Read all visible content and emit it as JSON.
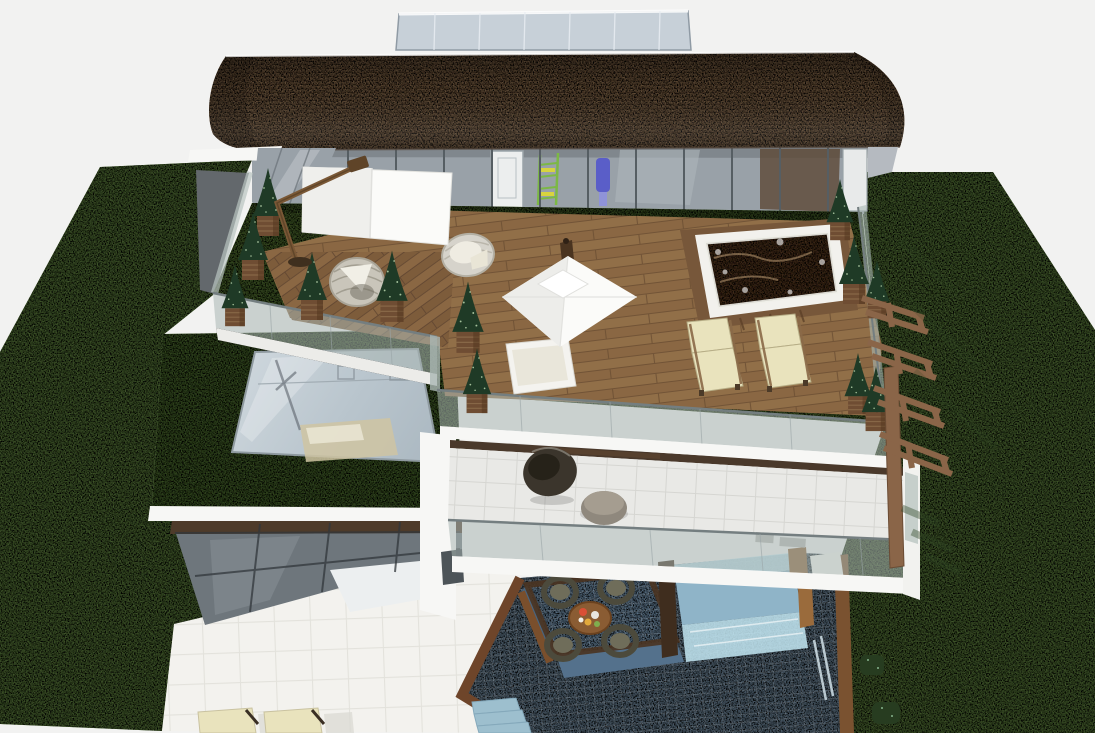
{
  "scene": {
    "type": "3d-architectural-render",
    "view": "aerial-three-quarter",
    "subject": "Modern multi-storey villa with curved brick roof, glass balustrade roof terrace, green roof skylight, balcony, pool and lawn",
    "background": "plain light studio backdrop"
  },
  "colors": {
    "background": "#f2f2f1",
    "lawn": "#5d7b40",
    "terrace_turf": "#567236",
    "green_roof": "#4e6b33",
    "roof_brick": "#8d7052",
    "roof_brick_joint": "#6f5339",
    "deck_wood": "#8a6743",
    "deck_wood_alt": "#916f48",
    "deck_plank_line": "#6a4d33",
    "facade_glass": "#99a1a8",
    "facade_mullion": "#565e63",
    "penthouse_glass": "#c7d0d8",
    "railing_glass": "#a9b7b2",
    "railing_frame": "#747e80",
    "white_structure": "#f7f7f5",
    "balcony_tile": "#e9e9e6",
    "patio_tile": "#f3f2ee",
    "pool_water": "#72899d",
    "pool_platform": "#7e9db8",
    "pool_glass": "#c3e7f3",
    "wood_trim": "#7a5230",
    "wood_dark": "#3f2d1e",
    "hot_tub_water": "#5e4128",
    "cushion_cream": "#e9e3bd",
    "topiary_green": "#1f3a26",
    "planter_wood": "#6f4d33",
    "fin_wood": "#8a6548",
    "walkway_gray": "#63686c",
    "wicker_light": "#cbc7bd",
    "wicker_dark": "#4c4a3c",
    "shelf_green": "#7cb845",
    "figure_blue": "#5a5ec8"
  },
  "objects": {
    "roof_terrace": [
      "curved brick barrel roof",
      "rooftop glass enclosure",
      "glass facade",
      "cantilever parasol",
      "square parasol",
      "hanging basket chair",
      "rattan armchair",
      "hot tub",
      "daybed",
      "sun loungers",
      "cone topiaries in wooden planters",
      "glass balustrade",
      "artificial turf",
      "hardwood deck"
    ],
    "middle_level": [
      "green roof",
      "roof skylight",
      "balcony with egg chair and pouf",
      "glass balustrade",
      "wooden louver screen"
    ],
    "ground_level": [
      "paved patio",
      "patio sun loungers",
      "swimming pool",
      "glass-walled lap pool",
      "sunken lounge platform",
      "round dining table with food",
      "rattan dining chairs",
      "pool steps",
      "box hedges",
      "lawn"
    ]
  },
  "counts": {
    "topiaries": 12,
    "terrace_loungers": 2,
    "patio_loungers": 2,
    "dining_chairs": 4,
    "parasols": 2
  }
}
